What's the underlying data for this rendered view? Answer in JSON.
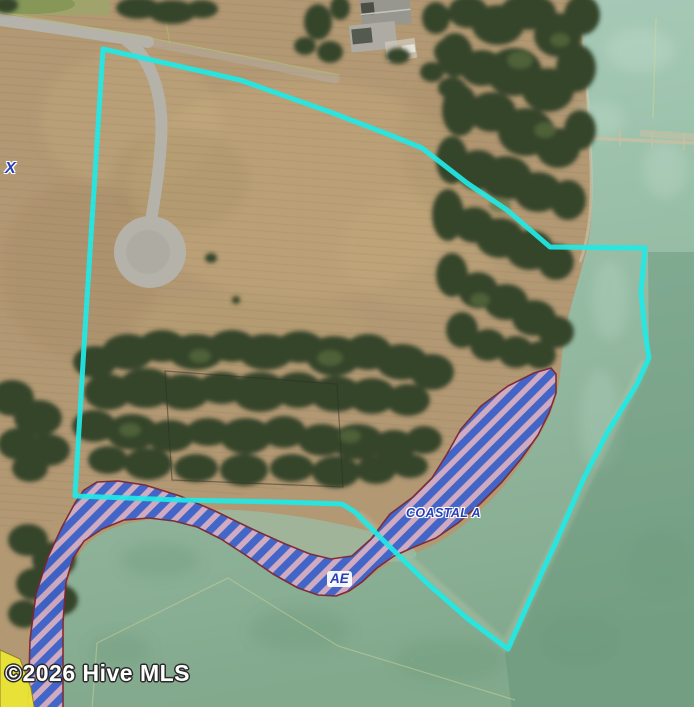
{
  "map": {
    "watermark": "©2026 Hive MLS",
    "zone_labels": [
      {
        "id": "zone-x",
        "text": "X"
      },
      {
        "id": "zone-coastal-a",
        "text": "COASTAL A"
      },
      {
        "id": "zone-ae",
        "text": "AE"
      }
    ]
  },
  "colors": {
    "property_line": "#1fe9e6",
    "stripe_blue": "#3d63cc",
    "stripe_pink": "#d2abc4",
    "zone_outline": "#7b2733",
    "zone_x_yellow": "#ebe534",
    "label_blue": "#2840b4",
    "ground_tan": "#b29873",
    "marsh_light": "#aacdbc",
    "marsh_dark": "#82a98c",
    "road_gray": "#b5b2aa",
    "tree_dark": "#36452c",
    "watermark_white": "#ffffff"
  }
}
